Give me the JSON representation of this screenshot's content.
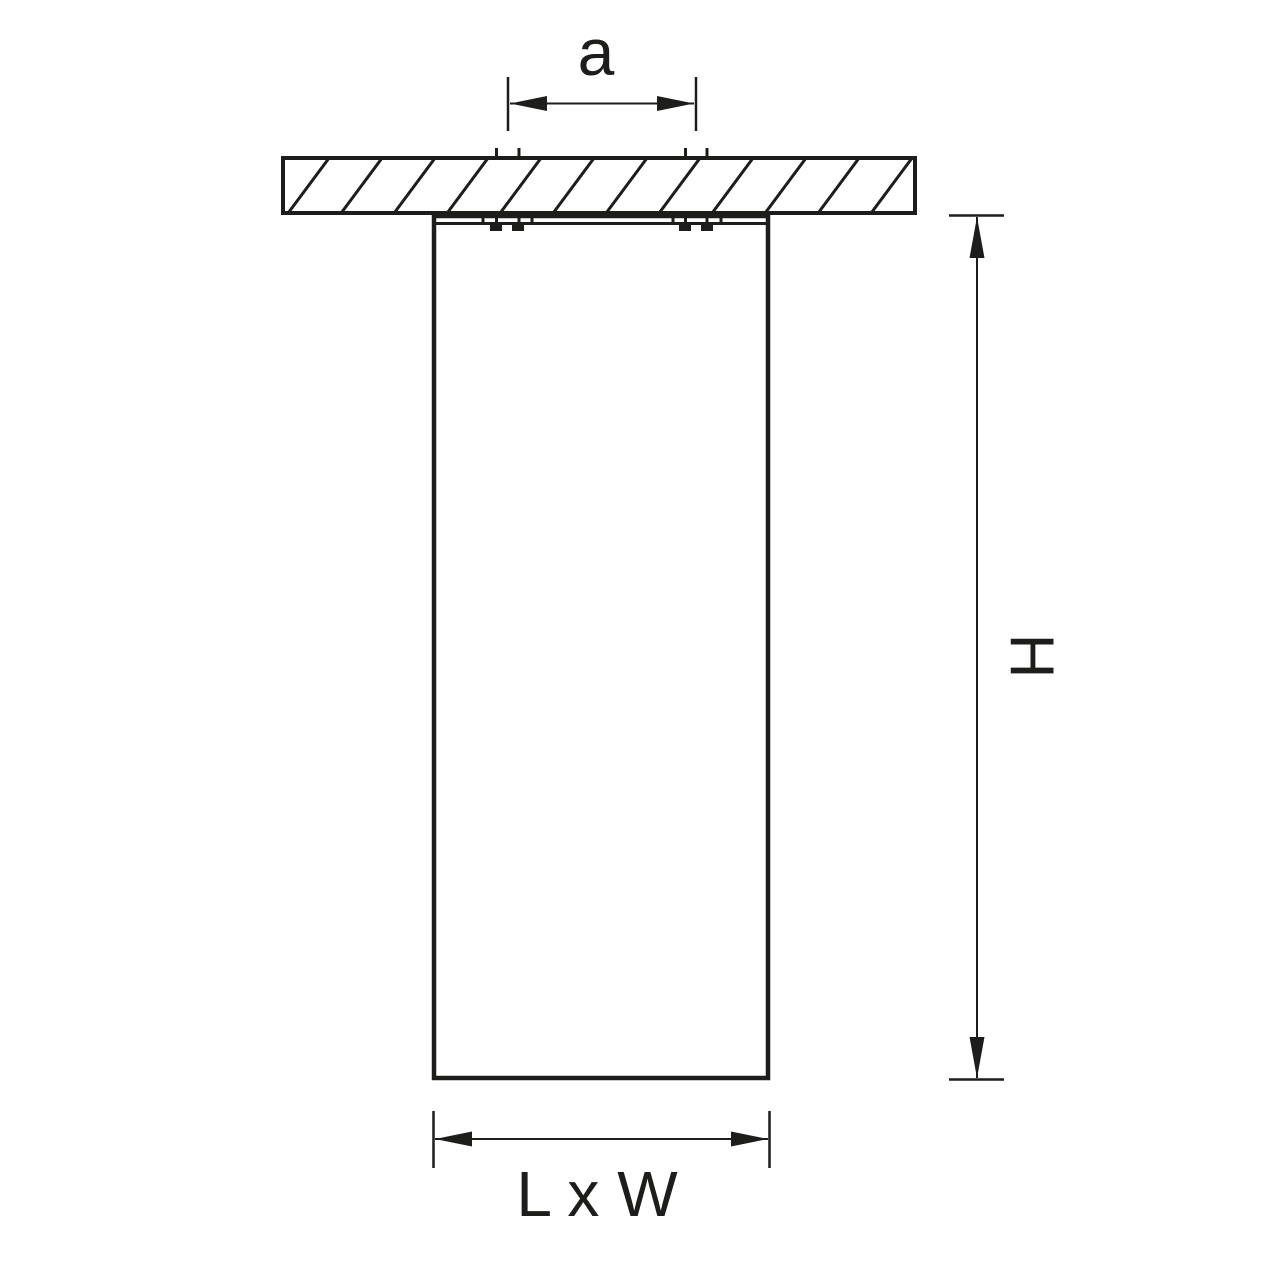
{
  "figure": {
    "type": "technical-dimension-drawing",
    "background_color": "#ffffff",
    "line_color": "#1d1d1b",
    "labels": {
      "hole_spacing": "a",
      "height": "H",
      "footprint": "L x W"
    }
  }
}
